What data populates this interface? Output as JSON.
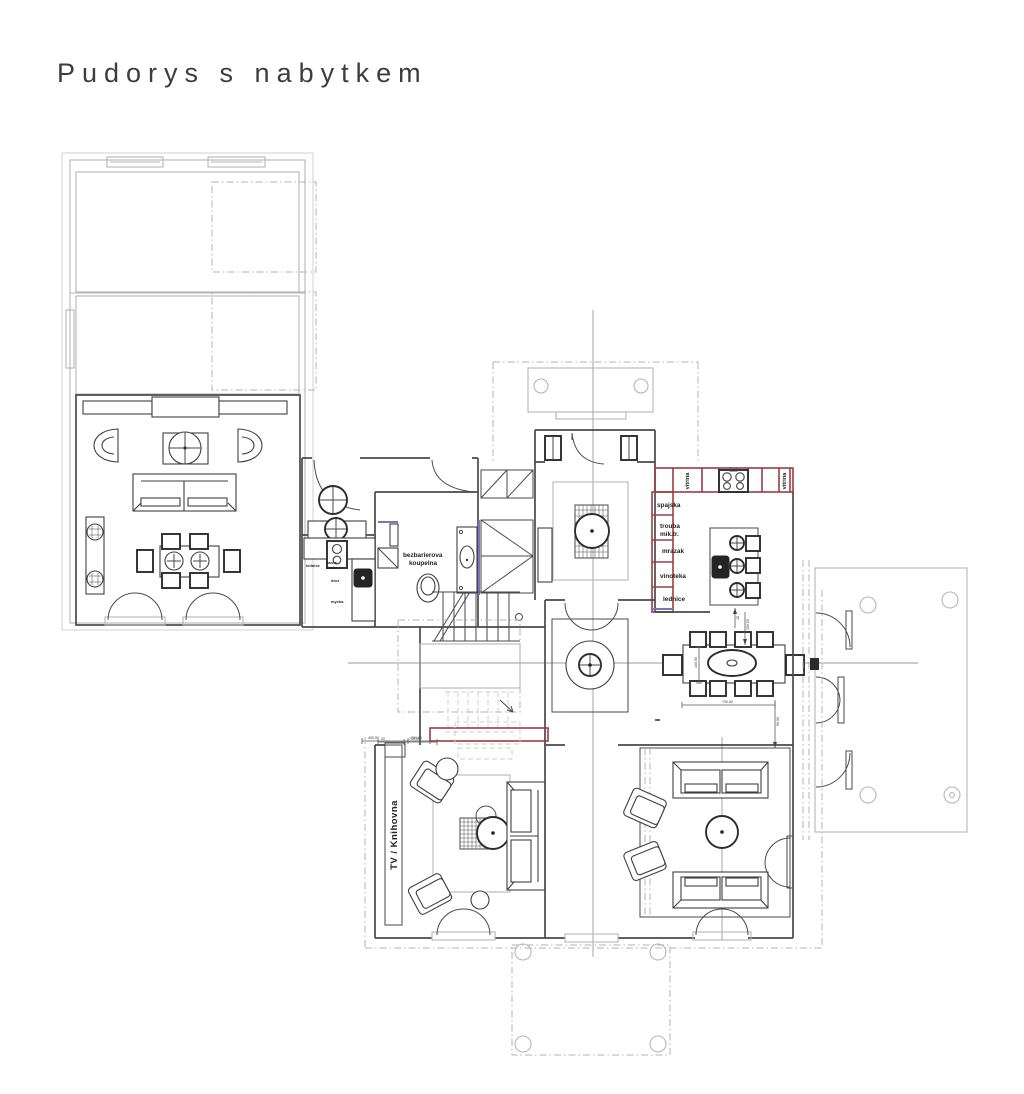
{
  "title": "Pudorys  s  nabytkem",
  "colors": {
    "walls": "#4a4a4a",
    "existing_gray": "#b6b6b6",
    "new_wall_red": "#9c3d42",
    "accent_purple": "#7b74b8",
    "centerline_gray": "#9b9b9b",
    "background": "#ffffff"
  },
  "kitchen": {
    "vitrina_left": "vitrina",
    "vitrina_right": "vitrina",
    "pantry": "spajska",
    "oven_line1": "trouba",
    "oven_line2": "mik.tr.",
    "freezer": "mrazak",
    "wine": "vinoteka",
    "fridge": "lednice"
  },
  "bathroom": {
    "label_line1": "bezbarierova",
    "label_line2": "koupelna"
  },
  "kitchenette": {
    "fridge": "lednice",
    "hob_line1": "varna",
    "hob_line2": "deska",
    "sink": "drez",
    "dishwasher": "mycka"
  },
  "tv_room": {
    "wall_label": "TV  /  Knihovna"
  },
  "dims": {
    "stairs_a": "450,50",
    "stairs_b": "750,50",
    "tv_a": "20",
    "tv_b": "750,50",
    "dining_width": "750,50",
    "dining_depth": "100,50",
    "dining_top": "150,50",
    "dining_right": "90,50",
    "island": "45"
  }
}
